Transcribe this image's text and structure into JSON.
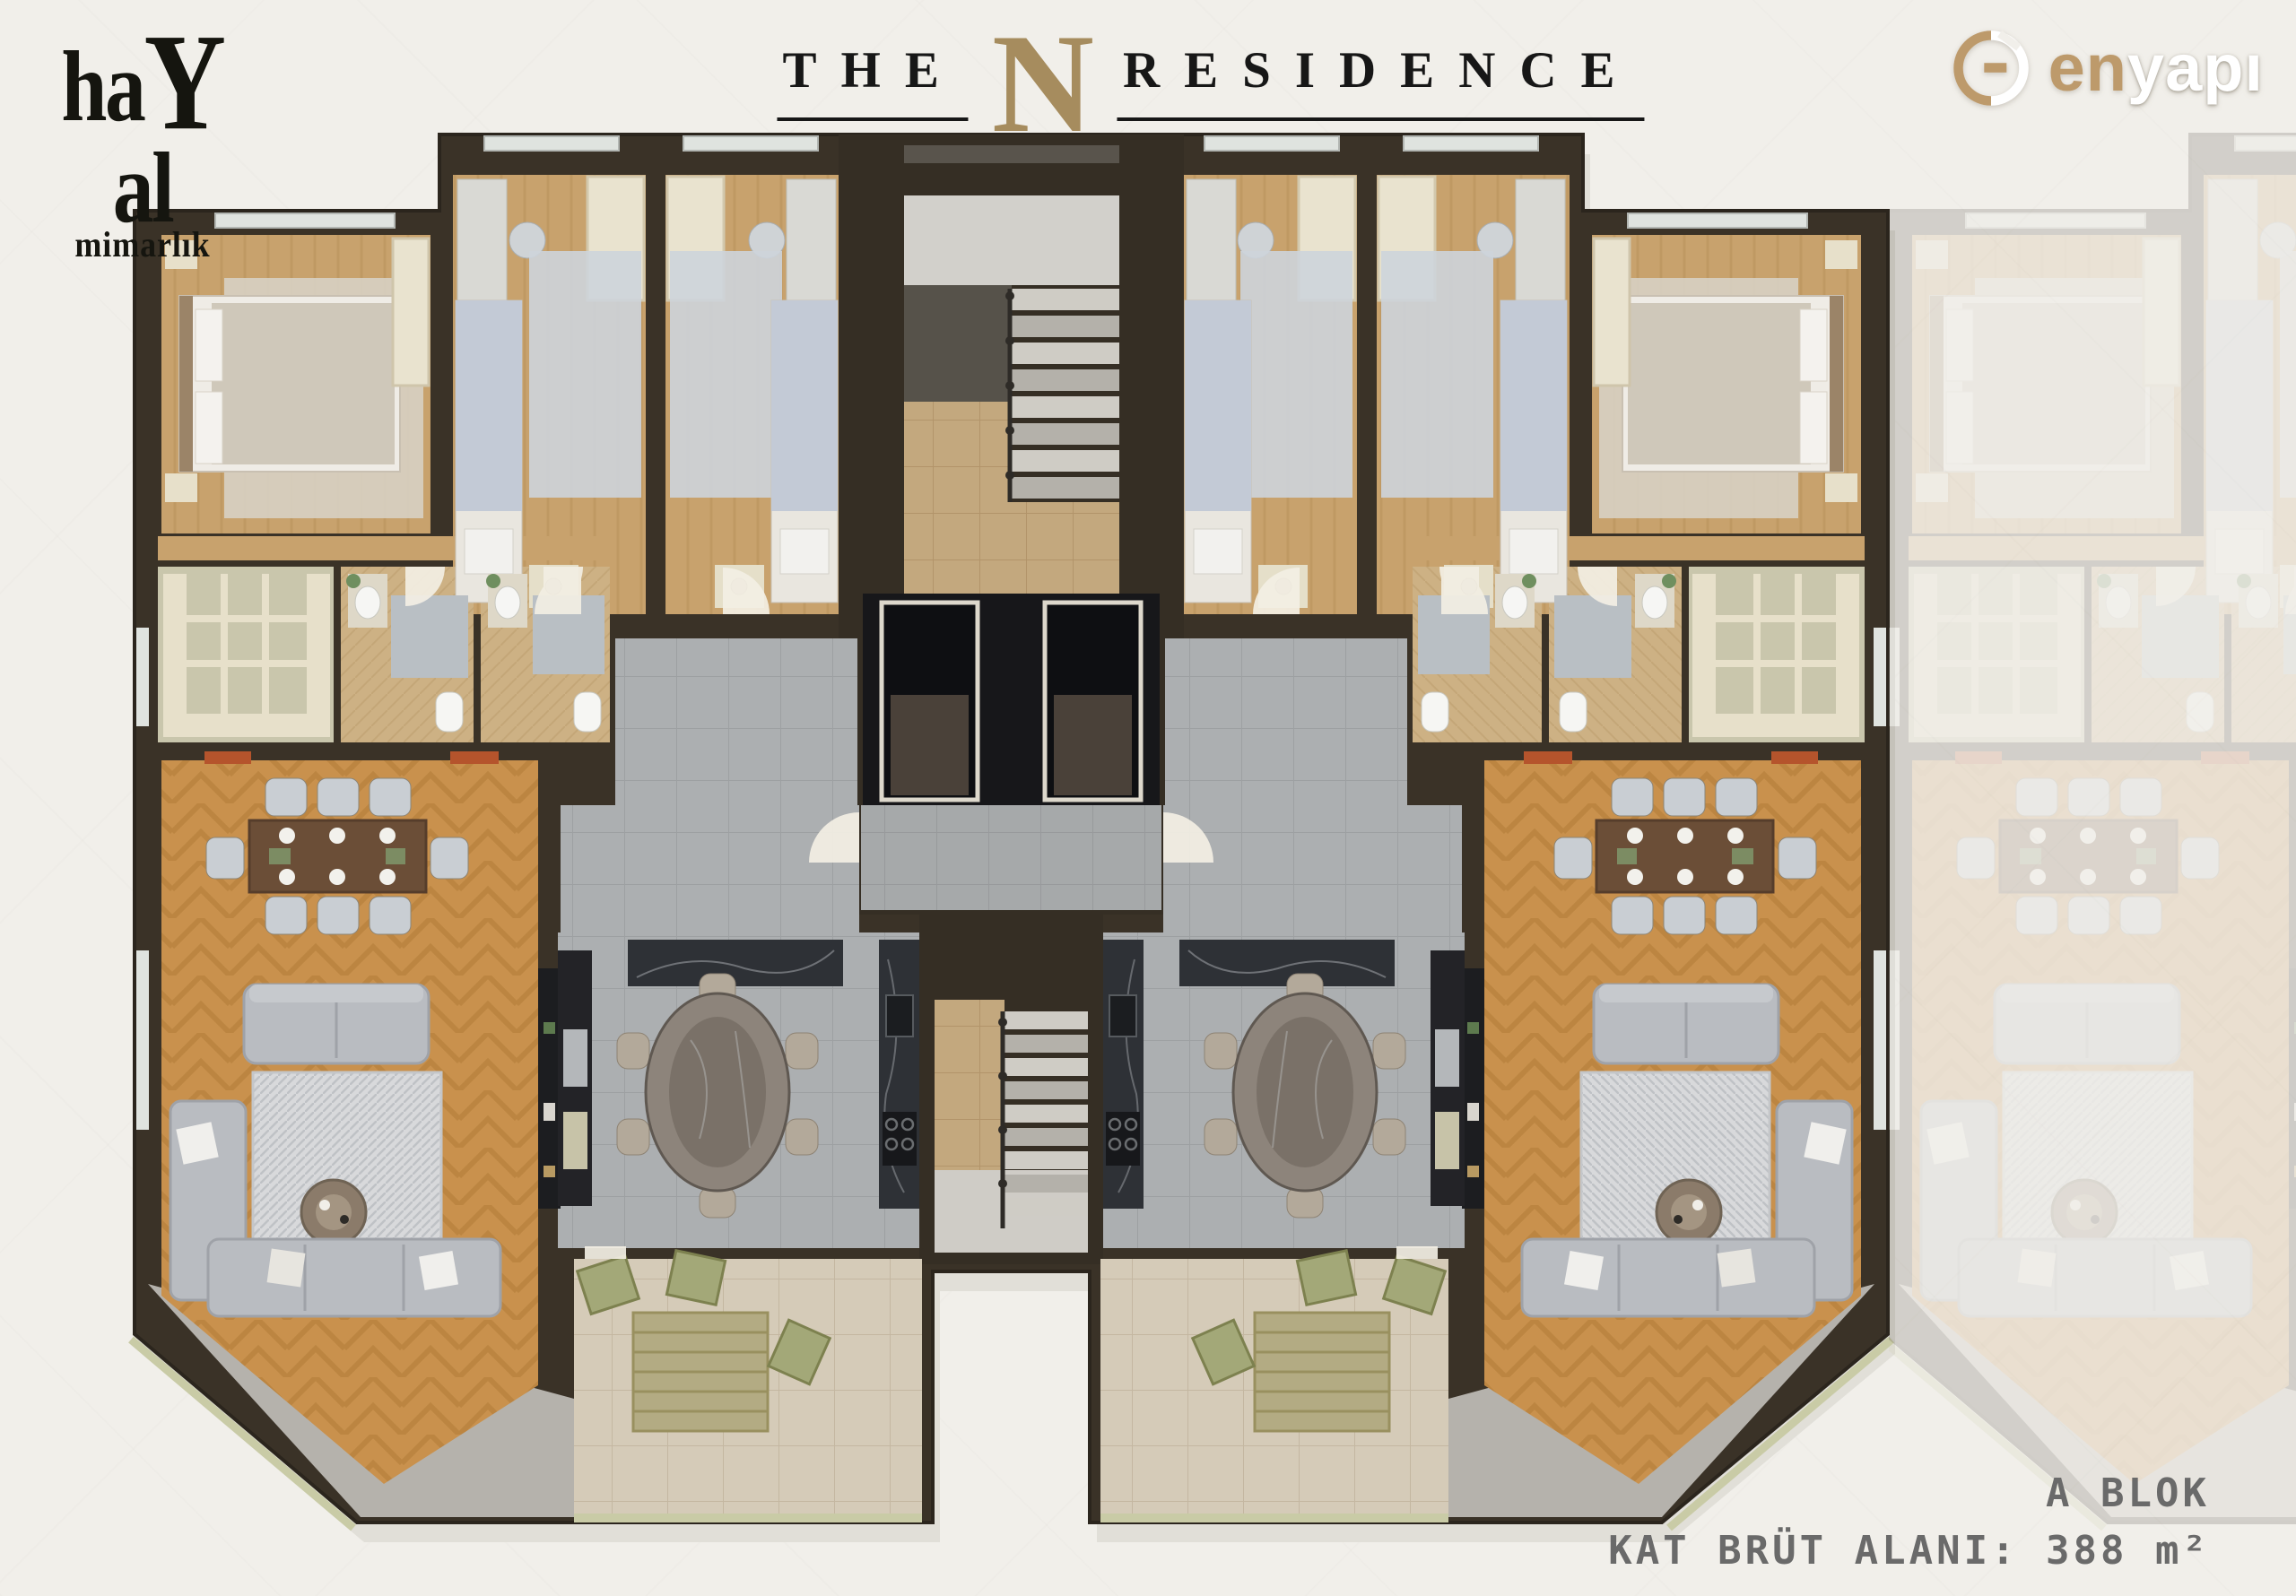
{
  "branding": {
    "architect": {
      "part1": "ha",
      "part_y": "y",
      "part2": "al",
      "subtitle": "mimarlık"
    },
    "developer": {
      "part1": "en",
      "part2": "yapı",
      "icon": "enyapi-circle-mark-icon"
    }
  },
  "title": {
    "word1": "THE",
    "letter": "N",
    "word2": "RESIDENCE"
  },
  "footer": {
    "block": "A BLOK",
    "area": "KAT BRÜT ALANI: 388 m²"
  },
  "palette": {
    "background": "#f1efea",
    "wall": "#3a3227",
    "living_wood": "#c9914d",
    "bedroom_wood": "#c8a26d",
    "gray_tile": "#acafb1",
    "beige_tile": "#c3a87e",
    "dark_marble": "#2e3136",
    "title_gold": "#a68c5e",
    "brand_gold": "#bd9a6b",
    "radiator_red": "#b5542c",
    "footer_gray": "#6a6a6a"
  }
}
